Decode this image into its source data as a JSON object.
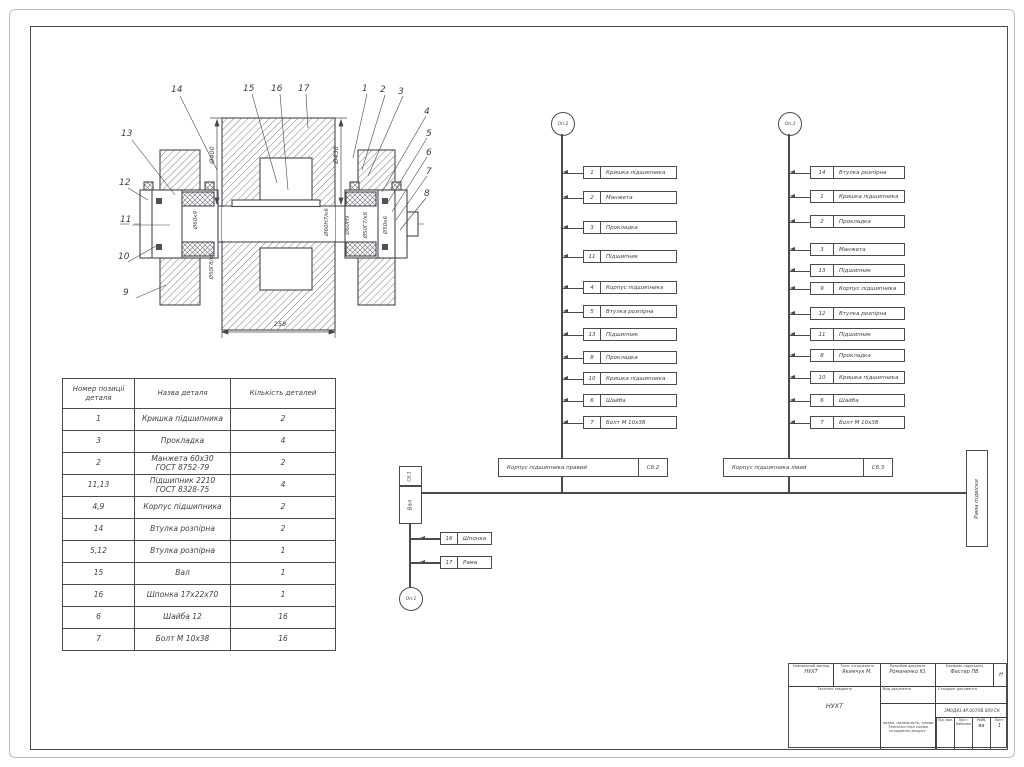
{
  "drawing": {
    "callouts": [
      {
        "n": "14",
        "x": 171,
        "y": 86
      },
      {
        "n": "15",
        "x": 243,
        "y": 85
      },
      {
        "n": "16",
        "x": 271,
        "y": 85
      },
      {
        "n": "17",
        "x": 298,
        "y": 85
      },
      {
        "n": "1",
        "x": 362,
        "y": 85
      },
      {
        "n": "2",
        "x": 380,
        "y": 86
      },
      {
        "n": "3",
        "x": 398,
        "y": 88
      },
      {
        "n": "4",
        "x": 424,
        "y": 108
      },
      {
        "n": "5",
        "x": 426,
        "y": 130
      },
      {
        "n": "6",
        "x": 426,
        "y": 149
      },
      {
        "n": "7",
        "x": 426,
        "y": 168
      },
      {
        "n": "8",
        "x": 424,
        "y": 190
      },
      {
        "n": "13",
        "x": 121,
        "y": 130
      },
      {
        "n": "12",
        "x": 119,
        "y": 179
      },
      {
        "n": "11",
        "x": 120,
        "y": 216
      },
      {
        "n": "10",
        "x": 118,
        "y": 253
      },
      {
        "n": "9",
        "x": 123,
        "y": 289
      }
    ],
    "fits": [
      {
        "t": "Ø60к9",
        "x": 196,
        "y": 220
      },
      {
        "t": "Ø50Г8/к6",
        "x": 212,
        "y": 266
      },
      {
        "t": "Ø60Н7/к6",
        "x": 327,
        "y": 222
      },
      {
        "t": "Ø60Н9",
        "x": 348,
        "y": 225
      },
      {
        "t": "Ø50Г7/к6",
        "x": 366,
        "y": 225
      },
      {
        "t": "Ø50к6",
        "x": 386,
        "y": 225
      }
    ],
    "dim_left": "Ø400",
    "dim_right": "Ø430",
    "dim_bottom": "258"
  },
  "parts_table": {
    "headers": [
      "Номер позиції деталя",
      "Назва деталя",
      "Кількість деталей"
    ],
    "rows": [
      {
        "pos": "1",
        "name": "Кришка підшипника",
        "qty": "2"
      },
      {
        "pos": "3",
        "name": "Прокладка",
        "qty": "4"
      },
      {
        "pos": "2",
        "name": "Манжета 60х30\nГОСТ 8752-79",
        "qty": "2"
      },
      {
        "pos": "11,13",
        "name": "Підшипник 2210\nГОСТ 8328-75",
        "qty": "4"
      },
      {
        "pos": "4,9",
        "name": "Корпус підшипника",
        "qty": "2"
      },
      {
        "pos": "14",
        "name": "Втулка розпірна",
        "qty": "2"
      },
      {
        "pos": "5,12",
        "name": "Втулка розпірна",
        "qty": "1"
      },
      {
        "pos": "15",
        "name": "Вал",
        "qty": "1"
      },
      {
        "pos": "16",
        "name": "Шпонка 17х22х70",
        "qty": "1"
      },
      {
        "pos": "6",
        "name": "Шайба 12",
        "qty": "16"
      },
      {
        "pos": "7",
        "name": "Болт М 10х38",
        "qty": "16"
      }
    ]
  },
  "scheme": {
    "node1": "Оп.1",
    "node2": "Оп.2",
    "node3": "Оп.3",
    "base_header": "Сб.1",
    "base_label": "Вал",
    "chain1": [
      {
        "n": "1",
        "label": "Кришка підшипника",
        "top": 166
      },
      {
        "n": "2",
        "label": "Манжета",
        "top": 191
      },
      {
        "n": "3",
        "label": "Прокладка",
        "top": 221
      },
      {
        "n": "11",
        "label": "Підшипник",
        "top": 250
      },
      {
        "n": "4",
        "label": "Корпус підшипника",
        "top": 281
      },
      {
        "n": "5",
        "label": "Втулка розпірна",
        "top": 305
      },
      {
        "n": "13",
        "label": "Підшипник",
        "top": 328
      },
      {
        "n": "8",
        "label": "Прокладка",
        "top": 351
      },
      {
        "n": "10",
        "label": "Кришка підшипника",
        "top": 372
      },
      {
        "n": "6",
        "label": "Шайба",
        "top": 394
      },
      {
        "n": "7",
        "label": "Болт М 10х38",
        "top": 416
      }
    ],
    "chain2": [
      {
        "n": "14",
        "label": "Втулка розпірна",
        "top": 166
      },
      {
        "n": "1",
        "label": "Кришка підшипника",
        "top": 190
      },
      {
        "n": "2",
        "label": "Прокладка",
        "top": 215
      },
      {
        "n": "3",
        "label": "Манжета",
        "top": 243
      },
      {
        "n": "13",
        "label": "Підшипник",
        "top": 264
      },
      {
        "n": "9",
        "label": "Корпус підшипника",
        "top": 282
      },
      {
        "n": "12",
        "label": "Втулка розпірна",
        "top": 307
      },
      {
        "n": "11",
        "label": "Підшипник",
        "top": 328
      },
      {
        "n": "8",
        "label": "Прокладка",
        "top": 349
      },
      {
        "n": "10",
        "label": "Кришка підшипника",
        "top": 371
      },
      {
        "n": "6",
        "label": "Шайба",
        "top": 394
      },
      {
        "n": "7",
        "label": "Болт М 10х38",
        "top": 416
      }
    ],
    "sub1_label": "Корпус підшипника правий",
    "sub1_code": "Сб.2",
    "sub2_label": "Корпус підшипника лівий",
    "sub2_code": "Сб.3",
    "frame_label": "Рама підвіски",
    "branch": [
      {
        "n": "16",
        "label": "Шпонка",
        "top": 532
      },
      {
        "n": "17",
        "label": "Рама",
        "top": 556
      }
    ]
  },
  "title_block": {
    "r1c1_label": "Навчальний заклад",
    "r1c1_value": "НУХТ",
    "r1c2_label": "Техн. узгодження",
    "r1c2_value": "Якимчук М.",
    "r1c3_label": "Розробив документ",
    "r1c3_value": "Романенко Ю.",
    "r1c4_label": "Керівник підрозділу",
    "r1c4_value": "Фастир ПВ",
    "r1c5_value": "Н",
    "left_label": "Технічне завдання",
    "left_value": "НУХТ",
    "mid_label": "Вид документа",
    "right_label": "Стандарт документа",
    "doc_lines": "назва, належність, назви\nТехнологічна схема\nскладання редукт.",
    "code": "ЗМ0Д43.4Р.007ЛВ.009.СК",
    "mini": [
      {
        "label": "Під. вал.",
        "value": ""
      },
      {
        "label": "Лист. Кабален",
        "value": ""
      },
      {
        "label": "Рейб.",
        "value": "ва"
      },
      {
        "label": "Лист.",
        "value": "1"
      }
    ]
  }
}
